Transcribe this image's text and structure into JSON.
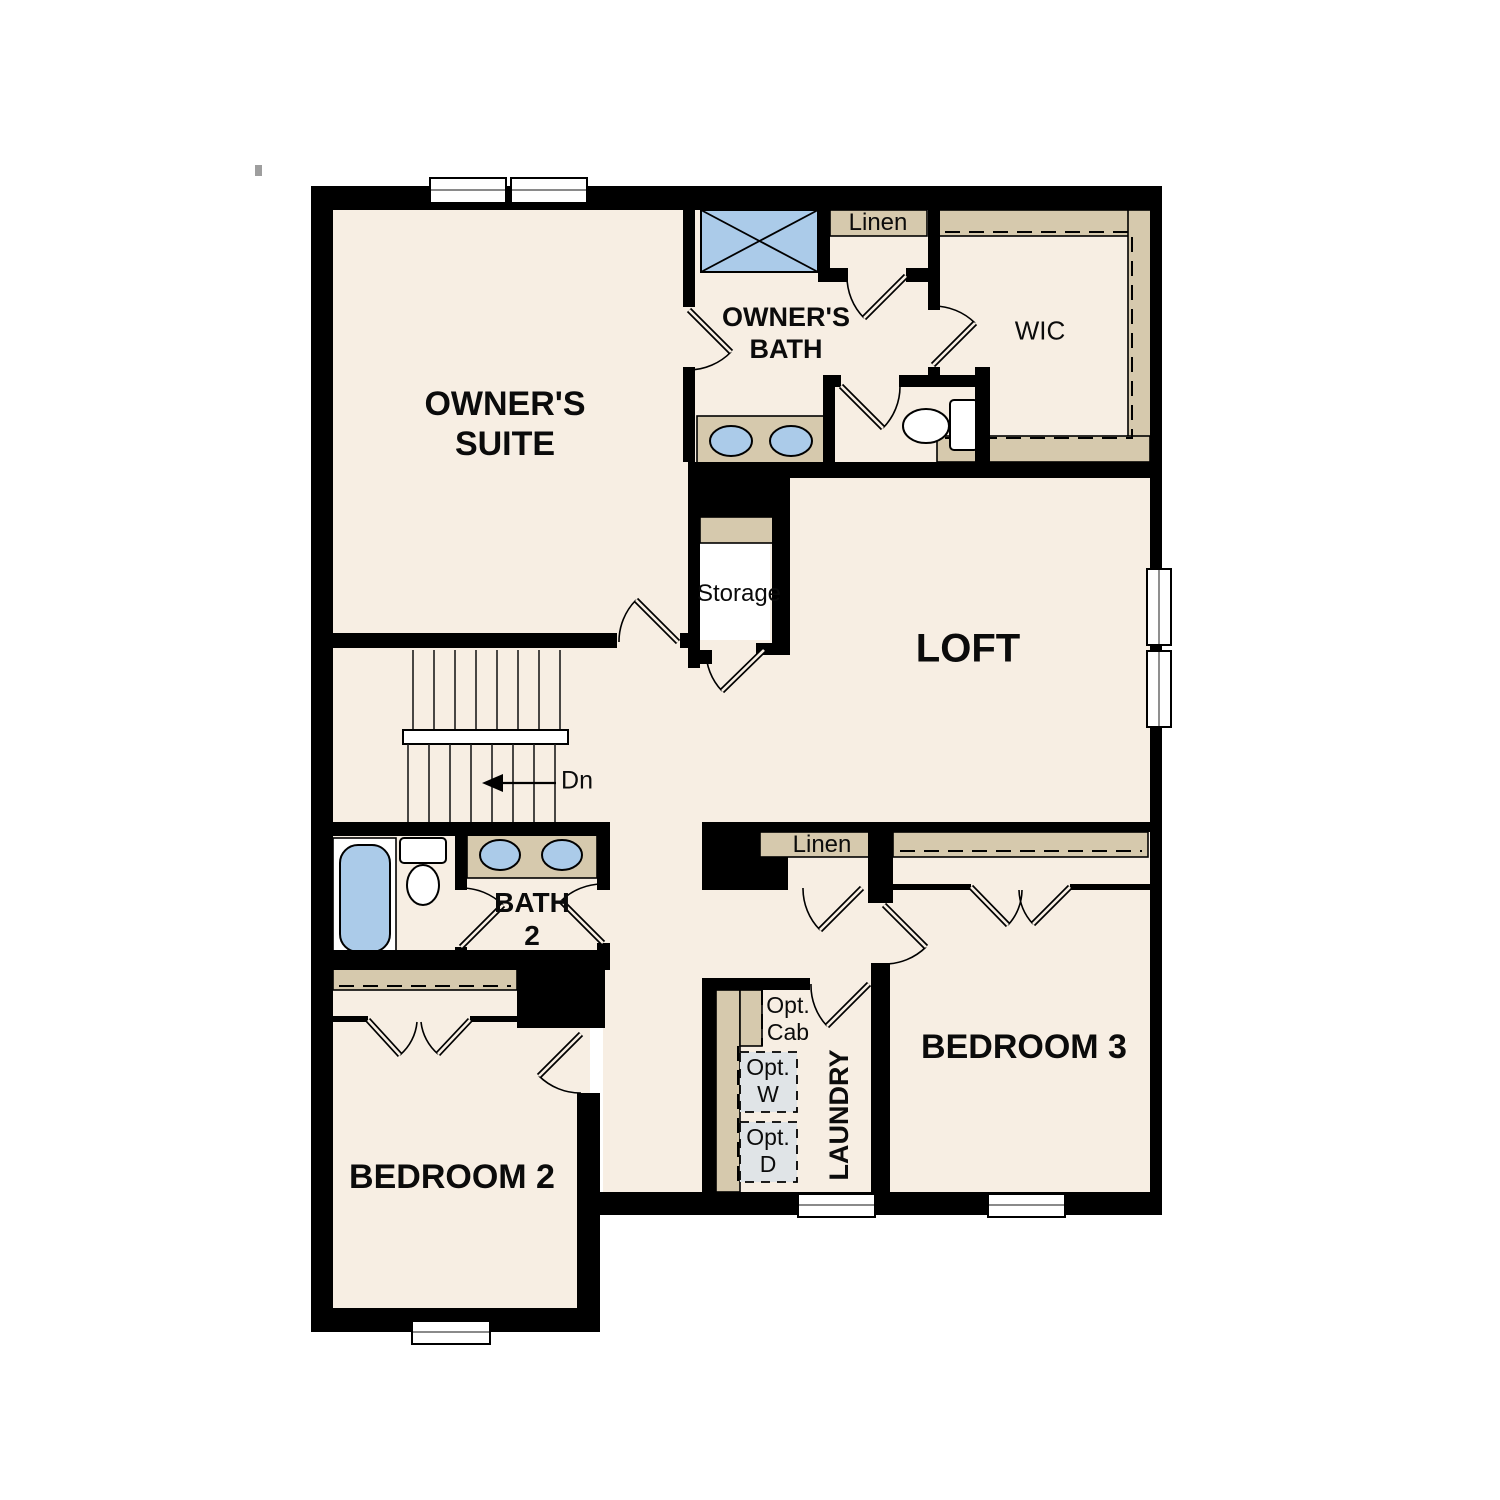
{
  "labels": {
    "owners_suite_line1": "OWNER'S",
    "owners_suite_line2": "SUITE",
    "owners_bath_line1": "OWNER'S",
    "owners_bath_line2": "BATH",
    "linen_upper": "Linen",
    "wic": "WIC",
    "storage": "Storage",
    "loft": "LOFT",
    "stairs_down": "Dn",
    "bath2_line1": "BATH",
    "bath2_line2": "2",
    "linen_hall": "Linen",
    "bedroom3": "BEDROOM 3",
    "bedroom2": "BEDROOM 2",
    "laundry": "LAUNDRY",
    "opt_cab_line1": "Opt.",
    "opt_cab_line2": "Cab",
    "opt_washer_line1": "Opt.",
    "opt_washer_line2": "W",
    "opt_dryer_line1": "Opt.",
    "opt_dryer_line2": "D"
  },
  "colors": {
    "background": "#ffffff",
    "floor": "#f7eee3",
    "wall": "#000000",
    "millwork_tan": "#d6c9ad",
    "fixture_blue": "#abcbe9",
    "optional_appliance_gray": "#e0e4e7"
  }
}
